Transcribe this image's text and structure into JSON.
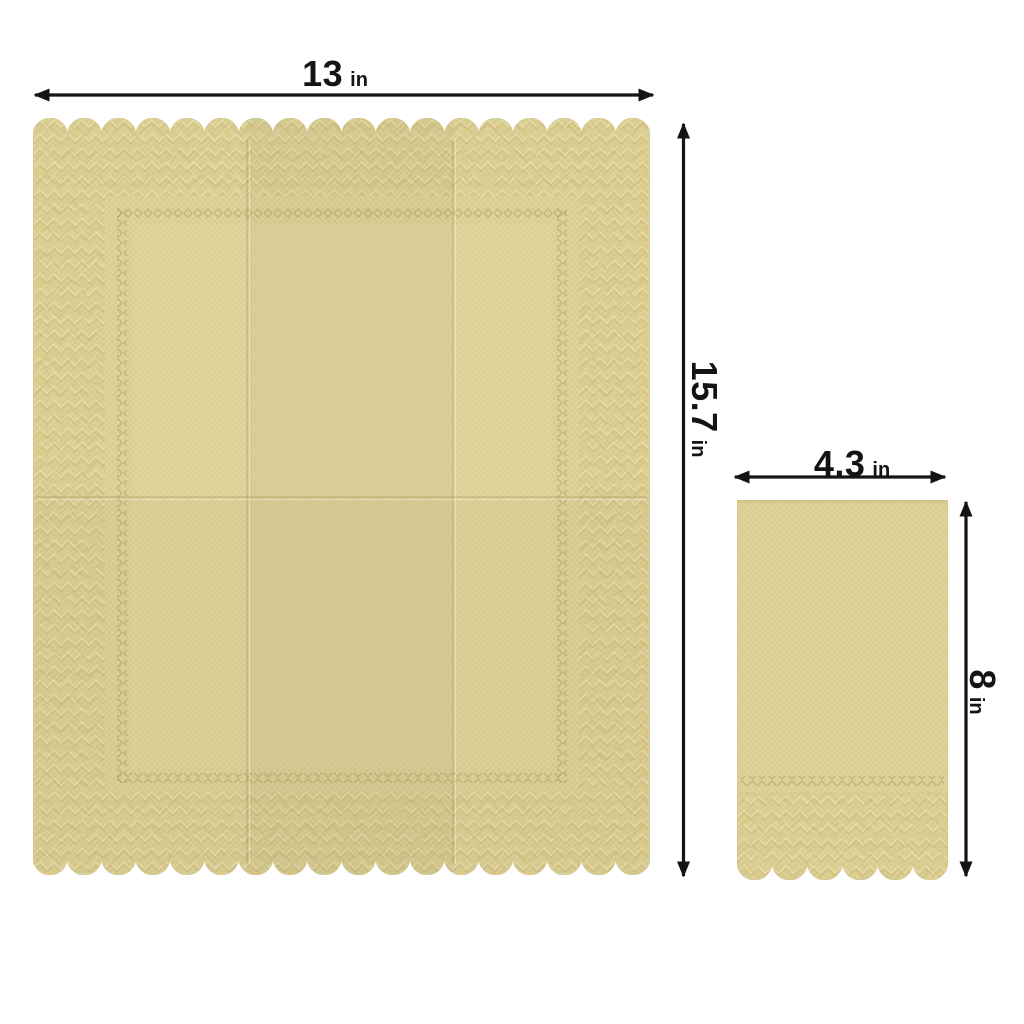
{
  "page": {
    "background": "#ffffff",
    "description": "Napkin size diagram: unfolded napkin with scalloped edges and folded napkin with dimension arrows"
  },
  "colors": {
    "background": "#ffffff",
    "arrow": "#141414",
    "napkin_base": "#dcd094",
    "napkin_edge": "#c9b87a",
    "band_tint": "#d0ba72",
    "emboss_light": "#f0e6b6",
    "emboss_dark": "#c2ae6d",
    "chain": "#b7a262",
    "fold": "#8a7440",
    "inner_light": "#e8dca4"
  },
  "labels": {
    "large_width": {
      "value": "13",
      "unit": "in"
    },
    "large_height": {
      "value": "15.7",
      "unit": "in"
    },
    "small_width": {
      "value": "4.3",
      "unit": "in"
    },
    "small_height": {
      "value": "8",
      "unit": "in"
    }
  },
  "items": {
    "large_napkin": "unfolded scallop-edge napkin",
    "small_napkin": "folded napkin with embossed bottom band"
  }
}
